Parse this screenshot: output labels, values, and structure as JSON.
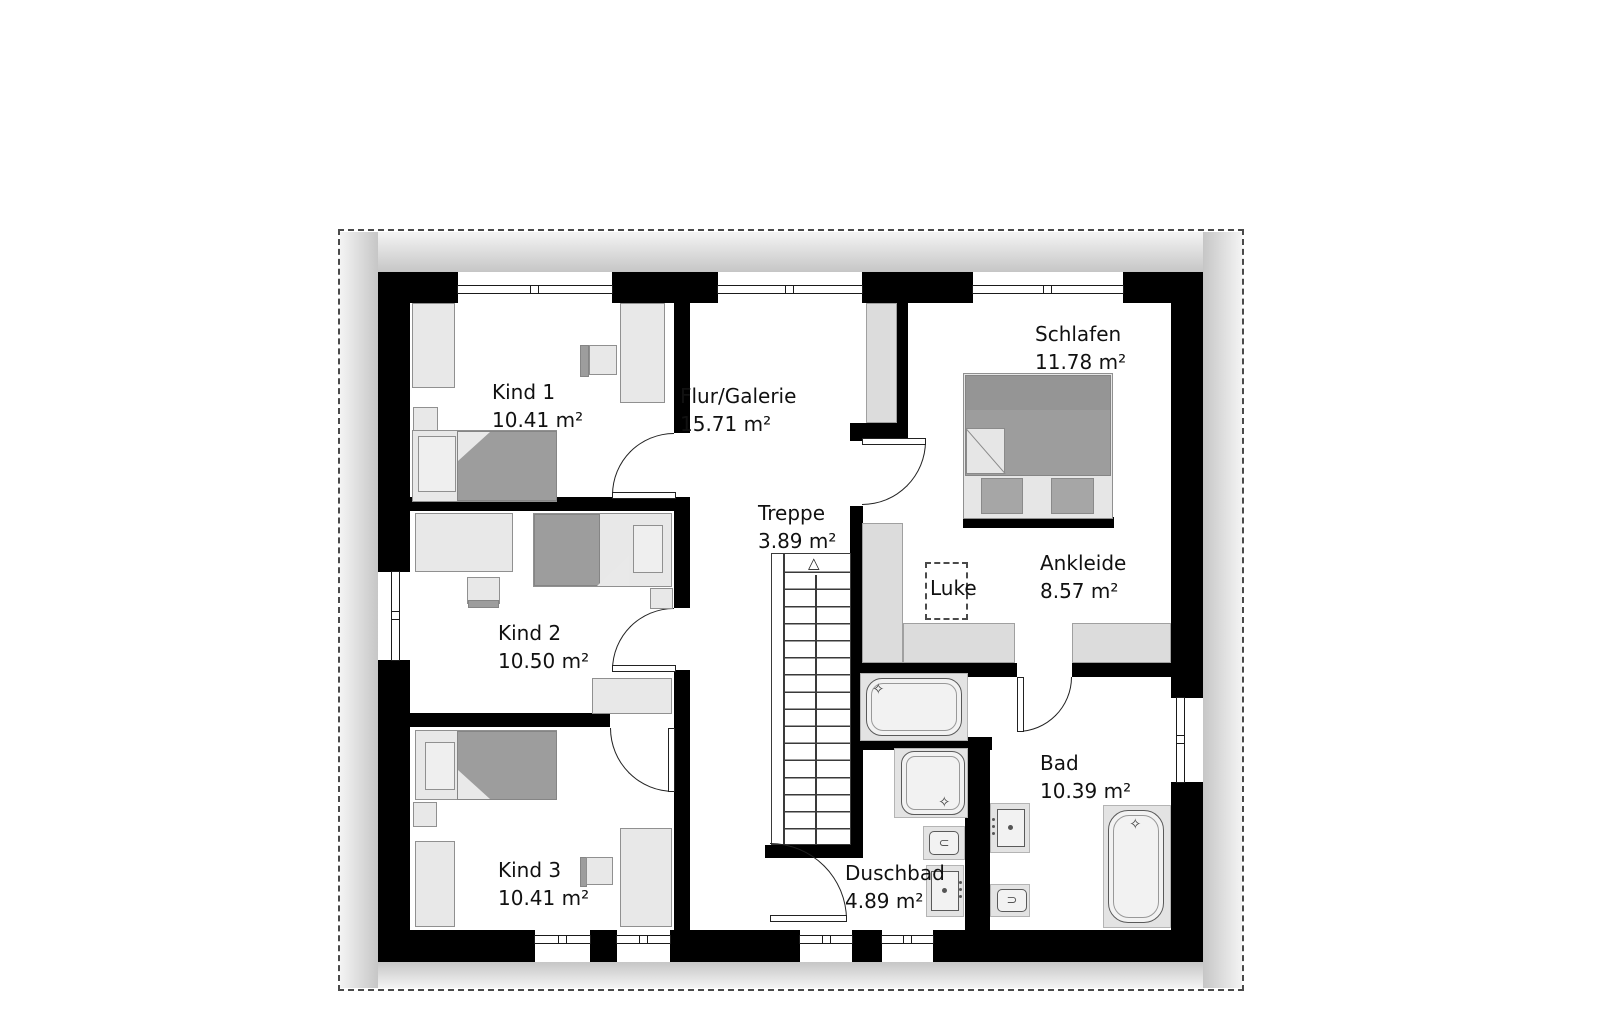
{
  "rooms": [
    {
      "id": "kind1",
      "name": "Kind 1",
      "area": "10.41 m²"
    },
    {
      "id": "kind2",
      "name": "Kind 2",
      "area": "10.50 m²"
    },
    {
      "id": "kind3",
      "name": "Kind 3",
      "area": "10.41 m²"
    },
    {
      "id": "flur",
      "name": "Flur/Galerie",
      "area": "15.71 m²"
    },
    {
      "id": "treppe",
      "name": "Treppe",
      "area": "3.89 m²"
    },
    {
      "id": "schlafen",
      "name": "Schlafen",
      "area": "11.78 m²"
    },
    {
      "id": "ankleide",
      "name": "Ankleide",
      "area": "8.57 m²"
    },
    {
      "id": "bad",
      "name": "Bad",
      "area": "10.39 m²"
    },
    {
      "id": "duschbad",
      "name": "Duschbad",
      "area": "4.89 m²"
    }
  ],
  "hatch": {
    "label": "Luke"
  },
  "icons": {
    "stairs_arrow": "△",
    "sparkle": "✧",
    "toilet_open_left": "⊃",
    "toilet_open_right": "⊂"
  },
  "colors": {
    "wall": "#000000",
    "furniture_light": "#e8e8e8",
    "furniture_dark": "#9d9d9d",
    "knee_wall": "#dcdcdc",
    "fixture": "#f2f2f2",
    "shadow_dark": "#c6c6c6",
    "shadow_light": "#f4f4f4",
    "text": "#111111"
  }
}
